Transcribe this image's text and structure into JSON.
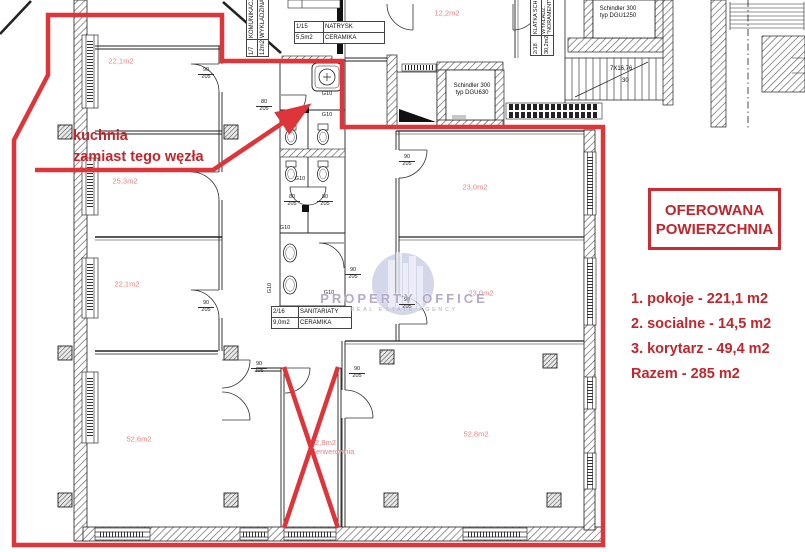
{
  "colors": {
    "red_outline": "#dd3539",
    "red_annotation": "#c2252b",
    "area_label_red": "#ef8080",
    "line_black": "#222222",
    "watermark_blue": "#a9aed6"
  },
  "annotation": {
    "line1": "kuchnia",
    "line2": "zamiast tego węzła"
  },
  "offer": {
    "title_line1": "OFEROWANA",
    "title_line2": "POWIERZCHNIA",
    "items": [
      "1. pokoje - 221,1 m2",
      "2. socialne - 14,5 m2",
      "3. korytarz - 49,4 m2",
      "Razem - 285 m2"
    ]
  },
  "crossed_room": {
    "area": "12,8m2",
    "name": "Serwerownia"
  },
  "rooms": [
    {
      "area": "22,1m2",
      "x": 121,
      "y": 61
    },
    {
      "area": "25,3m2",
      "x": 125,
      "y": 181
    },
    {
      "area": "22,1m2",
      "x": 127,
      "y": 284
    },
    {
      "area": "52,6m2",
      "x": 139,
      "y": 439
    },
    {
      "area": "12,2m2",
      "x": 447,
      "y": 13
    },
    {
      "area": "23,0m2",
      "x": 475,
      "y": 187
    },
    {
      "area": "23,0m2",
      "x": 481,
      "y": 293
    },
    {
      "area": "52,8m2",
      "x": 476,
      "y": 434
    }
  ],
  "tables": {
    "natrysk": {
      "rows": [
        [
          "1/15",
          "NATRYSK"
        ],
        [
          "5,5m2",
          "CERAMIKA"
        ]
      ]
    },
    "sanitariaty": {
      "rows": [
        [
          "2/16",
          "SANITARIATY"
        ],
        [
          "9,0m2",
          "CERAMIKA"
        ]
      ]
    },
    "komunikacja": {
      "rows": [
        [
          "1/7",
          "KOMUNIKACJA"
        ],
        [
          "12m2",
          "WYKŁADZINA"
        ]
      ]
    },
    "klatka": {
      "rows": [
        [
          "2/18",
          "KLATKA SCH."
        ],
        [
          "30,2m2",
          "WYKŁADZ. \"NORAMENT\""
        ]
      ]
    }
  },
  "elevators": [
    {
      "line1": "Schindler 300",
      "line2": "typ DGU630"
    },
    {
      "line1": "Schindler 300",
      "line2": "typ DGU1250"
    }
  ],
  "stairs": {
    "label": "7X16,76",
    "count": "30"
  },
  "door_labels": [
    {
      "w": "90",
      "h": "205",
      "x": 206,
      "y": 68
    },
    {
      "w": "80",
      "h": "205",
      "x": 264,
      "y": 100
    },
    {
      "w": "80",
      "h": "205",
      "x": 292,
      "y": 195
    },
    {
      "w": "80",
      "h": "205",
      "x": 325,
      "y": 195
    },
    {
      "w": "90",
      "h": "205",
      "x": 353,
      "y": 268
    },
    {
      "w": "90",
      "h": "205",
      "x": 206,
      "y": 301
    },
    {
      "w": "90",
      "h": "205",
      "x": 407,
      "y": 155
    },
    {
      "w": "90",
      "h": "205",
      "x": 407,
      "y": 298
    },
    {
      "w": "90",
      "h": "205",
      "x": 259,
      "y": 362
    },
    {
      "w": "90",
      "h": "205",
      "x": 357,
      "y": 367
    }
  ],
  "g10_labels": [
    {
      "text": "G10",
      "x": 327,
      "y": 94,
      "vertical": false
    },
    {
      "text": "G10",
      "x": 327,
      "y": 115,
      "vertical": false
    },
    {
      "text": "G10",
      "x": 300,
      "y": 179,
      "vertical": false
    },
    {
      "text": "G10",
      "x": 285,
      "y": 228,
      "vertical": false
    },
    {
      "text": "G10",
      "x": 329,
      "y": 293,
      "vertical": false
    },
    {
      "text": "G10",
      "x": 270,
      "y": 288,
      "vertical": true
    }
  ],
  "watermark": {
    "line1": "PROPERTY OFFICE",
    "line2": "REAL ESTATE AGENCY"
  }
}
